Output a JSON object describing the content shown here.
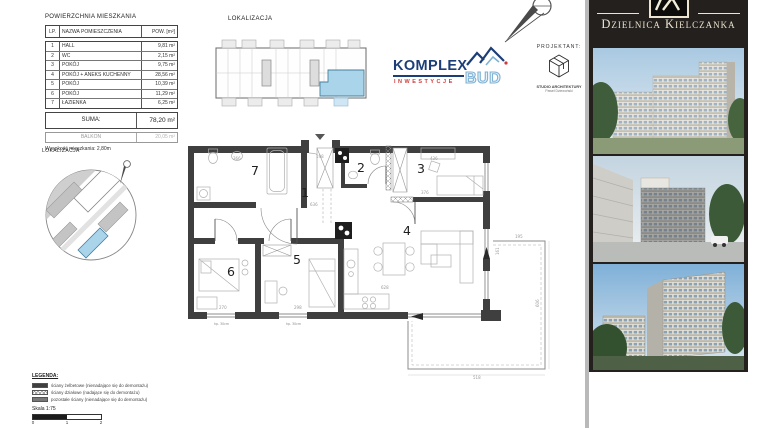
{
  "area_table": {
    "title": "POWIERZCHNIA MIESZKANIA",
    "col_lp": "LP.",
    "col_name": "NAZWA POMIESZCZENIA",
    "col_area": "POW. [m²]",
    "rows": [
      {
        "lp": "1",
        "name": "HALL",
        "area": "9,81 m²"
      },
      {
        "lp": "2",
        "name": "WC",
        "area": "2,15 m²"
      },
      {
        "lp": "3",
        "name": "POKÓJ",
        "area": "9,75 m²"
      },
      {
        "lp": "4",
        "name": "POKÓJ + ANEKS KUCHENNY",
        "area": "28,56 m²"
      },
      {
        "lp": "5",
        "name": "POKÓJ",
        "area": "10,39 m²"
      },
      {
        "lp": "6",
        "name": "POKÓJ",
        "area": "11,29 m²"
      },
      {
        "lp": "7",
        "name": "ŁAZIENKA",
        "area": "6,25 m²"
      }
    ],
    "suma_label": "SUMA:",
    "suma_value": "78,20 m²",
    "balkon_label": "BALKON",
    "balkon_value": "20,05 m²",
    "height_note": "Wysokość mieszkania: 2,80m"
  },
  "lokalizacja_top": {
    "title": "LOKALIZACJA"
  },
  "lokalizacja_side": {
    "title": "LOKALIZACJA"
  },
  "komplex_logo": {
    "line1": "KOMPLEX",
    "line2": "INWESTYCJE",
    "line3": "BUD"
  },
  "projektant": {
    "label": "PROJEKTANT:",
    "studio": "STUDIO ARCHITEKTURY",
    "name": "Paweł Dziewoński"
  },
  "brand_panel": {
    "title": "Dzielnica Kielczanka"
  },
  "floor_plan": {
    "room_numbers": [
      "1",
      "2",
      "3",
      "4",
      "5",
      "6",
      "7"
    ],
    "dims": [
      "198",
      "366",
      "636",
      "376",
      "436",
      "270",
      "298",
      "628",
      "606",
      "518",
      "195",
      "161"
    ],
    "window_note": "hp. 30cm"
  },
  "legend": {
    "title": "LEGENDA:",
    "items": [
      "ściany żelbetowe (nienadające się do demontażu)",
      "ściany działowe (nadające się do demontażu)",
      "pozostałe ściany (nienadające się do demontażu)"
    ],
    "scale_label": "Skala 1:75",
    "ticks": [
      "0",
      "1",
      "2"
    ]
  },
  "colors": {
    "unit_highlight": "#a9d4ea",
    "wall": "#3f3f3f",
    "brand_navy": "#1c3e78",
    "brand_red": "#d23b38",
    "brand_light_blue": "#8fc0de",
    "panel_bg": "#23201e",
    "panel_text": "#ece4cf"
  }
}
